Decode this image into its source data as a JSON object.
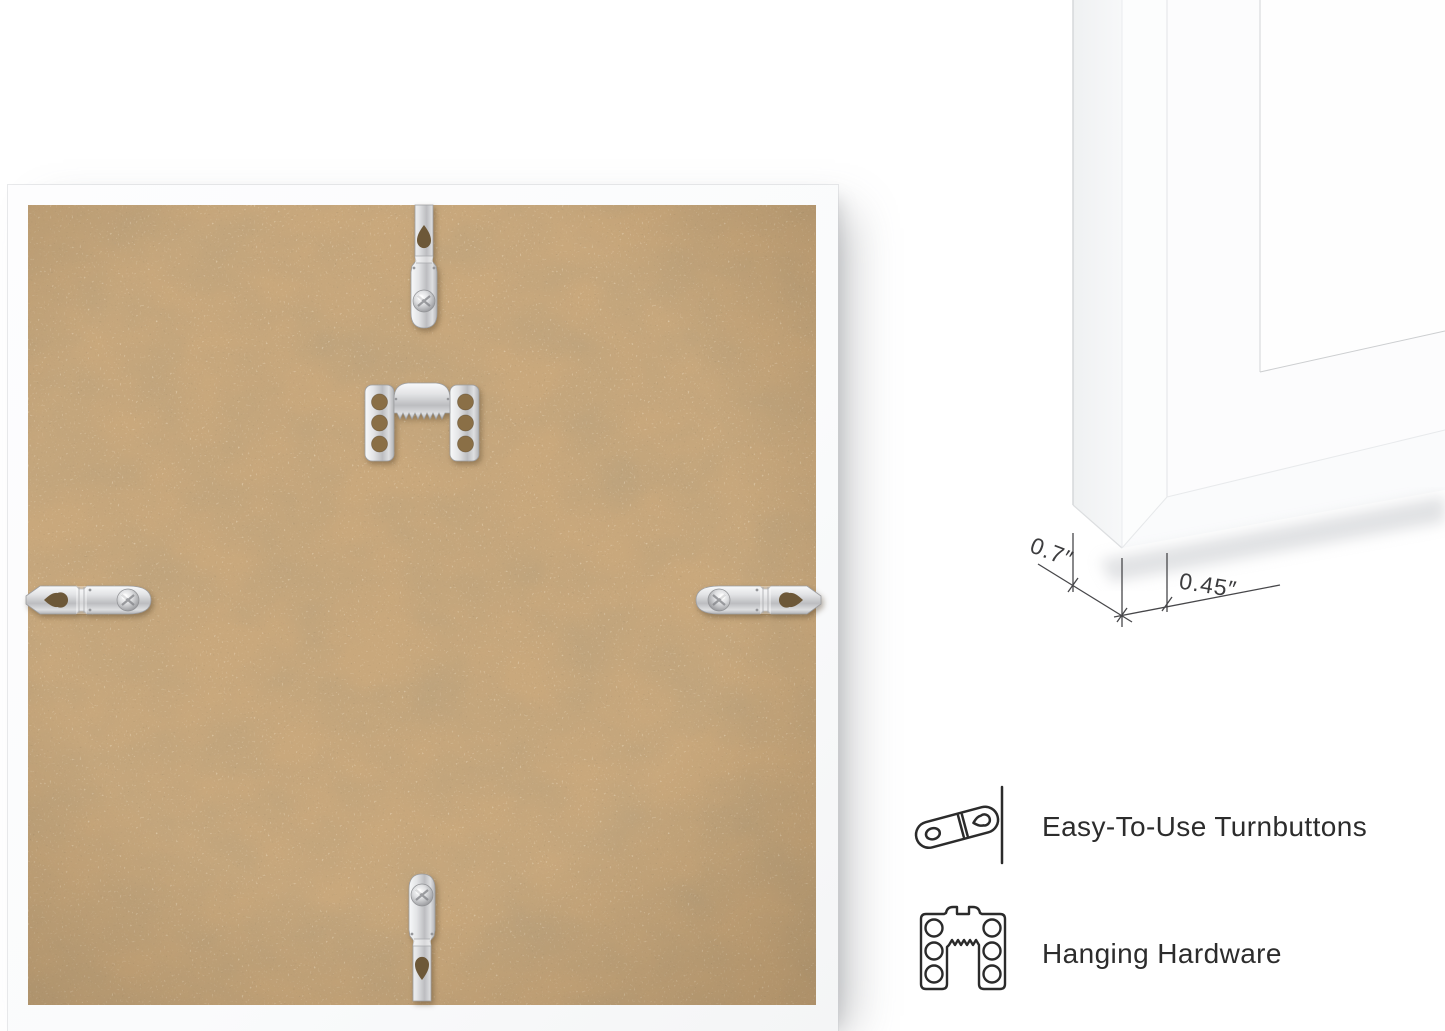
{
  "page": {
    "background_color": "#ffffff"
  },
  "product_photo": {
    "frame_color": "#fcfcfd",
    "backing_color": "#c9a87c",
    "hardware_metal_color": "#d7d8da",
    "hardware": {
      "top": "turnbutton",
      "bottom": "turnbutton",
      "left": "turnbutton",
      "right": "turnbutton",
      "center": "sawtooth-hanger"
    }
  },
  "corner_detail": {
    "depth_label": "0.7″",
    "face_label": "0.45″",
    "line_color": "#47474a"
  },
  "features": {
    "text_color": "#2c2c2c",
    "items": [
      {
        "icon": "turnbutton-icon",
        "label": "Easy-To-Use Turnbuttons"
      },
      {
        "icon": "hanging-hardware-icon",
        "label": "Hanging Hardware"
      }
    ]
  }
}
